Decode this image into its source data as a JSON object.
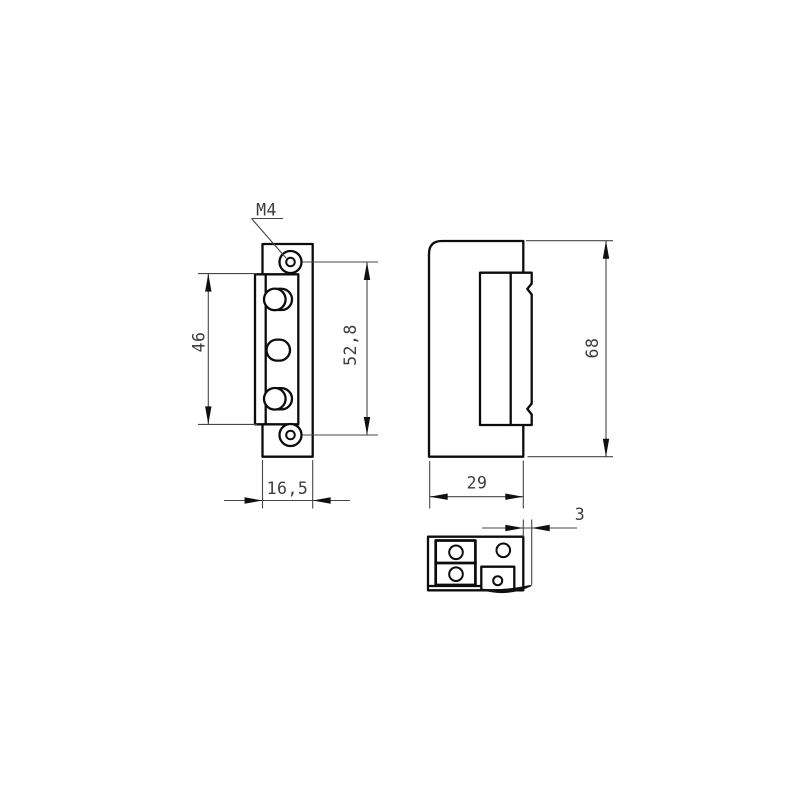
{
  "drawing": {
    "kind": "technical-orthographic-drawing",
    "views": [
      "front",
      "side",
      "bottom"
    ]
  },
  "annotations": {
    "thread_label": "M4"
  },
  "dimensions": {
    "body_height": {
      "label": "46",
      "value": 46
    },
    "hole_spacing": {
      "label": "52,8",
      "value": 52.8
    },
    "faceplate_width": {
      "label": "16,5",
      "value": 16.5
    },
    "body_depth": {
      "label": "29",
      "value": 29
    },
    "overall_height": {
      "label": "68",
      "value": 68
    },
    "lip_offset": {
      "label": "3",
      "value": 3
    }
  }
}
